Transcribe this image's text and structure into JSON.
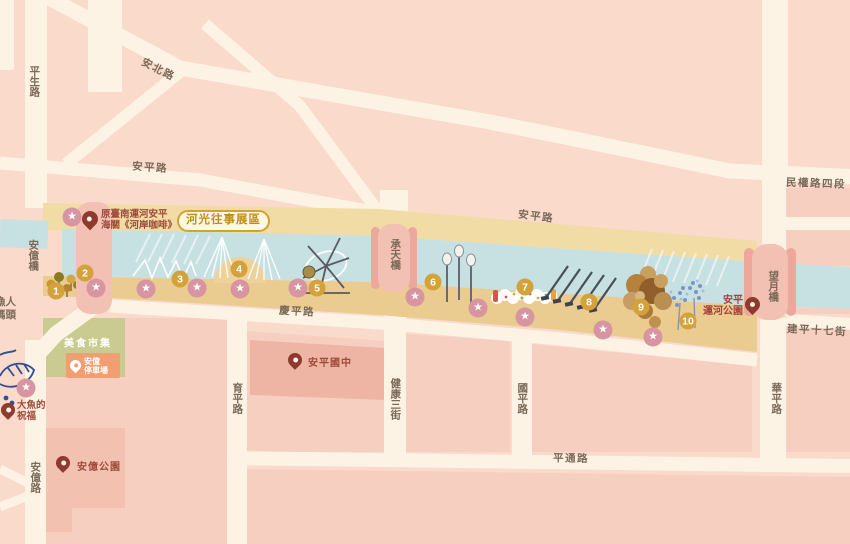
{
  "badge": {
    "label": "河光往事展區"
  },
  "poi": {
    "coffee": {
      "line1": "原臺南運河安平",
      "line2": "海關《河岸咖啡》"
    },
    "market": {
      "label": "美食市集"
    },
    "parking": {
      "line1": "安億",
      "line2": "停車場"
    },
    "school": {
      "label": "安平國中"
    },
    "fish": {
      "line1": "大魚的",
      "line2": "祝福"
    },
    "anyi_park": {
      "label": "安億公園"
    },
    "canal_park": {
      "line1": "安平",
      "line2": "運河公園"
    },
    "wharf": {
      "line1": "漁人",
      "line2": "碼頭"
    }
  },
  "road_labels": [
    {
      "text": "平生路",
      "x": 34,
      "y": 81,
      "v": true
    },
    {
      "text": "安北路",
      "x": 158,
      "y": 70,
      "rot": 27
    },
    {
      "text": "安平路",
      "x": 150,
      "y": 168,
      "rot": 4
    },
    {
      "text": "安平路",
      "x": 536,
      "y": 217,
      "rot": 7
    },
    {
      "text": "民權路四段",
      "x": 816,
      "y": 184,
      "rot": 2
    },
    {
      "text": "安億橋",
      "x": 33,
      "y": 255,
      "v": true
    },
    {
      "text": "承天橋",
      "x": 395,
      "y": 254,
      "v": true
    },
    {
      "text": "望月橋",
      "x": 773,
      "y": 286,
      "v": true
    },
    {
      "text": "慶平路",
      "x": 297,
      "y": 312,
      "rot": 3
    },
    {
      "text": "建平十七街",
      "x": 817,
      "y": 331,
      "rot": 3
    },
    {
      "text": "育平路",
      "x": 237,
      "y": 398,
      "v": true
    },
    {
      "text": "健康三街",
      "x": 395,
      "y": 399,
      "v": true
    },
    {
      "text": "國平路",
      "x": 522,
      "y": 398,
      "v": true
    },
    {
      "text": "華平路",
      "x": 776,
      "y": 398,
      "v": true
    },
    {
      "text": "平通路",
      "x": 571,
      "y": 459,
      "rot": 1
    },
    {
      "text": "安億路",
      "x": 35,
      "y": 477,
      "v": true
    }
  ],
  "markers": [
    {
      "n": "1",
      "x": 56,
      "y": 291
    },
    {
      "n": "2",
      "x": 85,
      "y": 273
    },
    {
      "n": "3",
      "x": 180,
      "y": 279
    },
    {
      "n": "4",
      "x": 239,
      "y": 269
    },
    {
      "n": "5",
      "x": 317,
      "y": 288
    },
    {
      "n": "6",
      "x": 433,
      "y": 282
    },
    {
      "n": "7",
      "x": 525,
      "y": 287
    },
    {
      "n": "8",
      "x": 589,
      "y": 302
    },
    {
      "n": "9",
      "x": 641,
      "y": 307
    },
    {
      "n": "10",
      "x": 688,
      "y": 321
    }
  ],
  "stars": [
    {
      "x": 96,
      "y": 288
    },
    {
      "x": 146,
      "y": 289
    },
    {
      "x": 197,
      "y": 288
    },
    {
      "x": 240,
      "y": 289
    },
    {
      "x": 298,
      "y": 288
    },
    {
      "x": 415,
      "y": 297
    },
    {
      "x": 478,
      "y": 308
    },
    {
      "x": 525,
      "y": 317
    },
    {
      "x": 603,
      "y": 330
    },
    {
      "x": 653,
      "y": 337
    },
    {
      "x": 72,
      "y": 217
    },
    {
      "x": 26,
      "y": 388
    }
  ],
  "icons": {
    "star": "★"
  },
  "colors": {
    "background": "#F9DACB",
    "block": "#F6CFC0",
    "block_dark": "#EEB5A4",
    "road": "#FDF3E4",
    "canal": "#C7E1E3",
    "gold_top": "#F1DCA6",
    "gold_bottom": "#EACB90",
    "bridge": "#F3C0B4",
    "marker_gold": "#D4A23B",
    "star_pink": "#D795A2",
    "pin_maroon": "#8E3B2F",
    "badge_gold": "#BE8E1A",
    "poi_text": "#9E4B39",
    "market_green": "#C9CB90",
    "parking_orange": "#F09E72",
    "road_label": "#7C6A59",
    "fish_blue": "#2F4E95"
  }
}
